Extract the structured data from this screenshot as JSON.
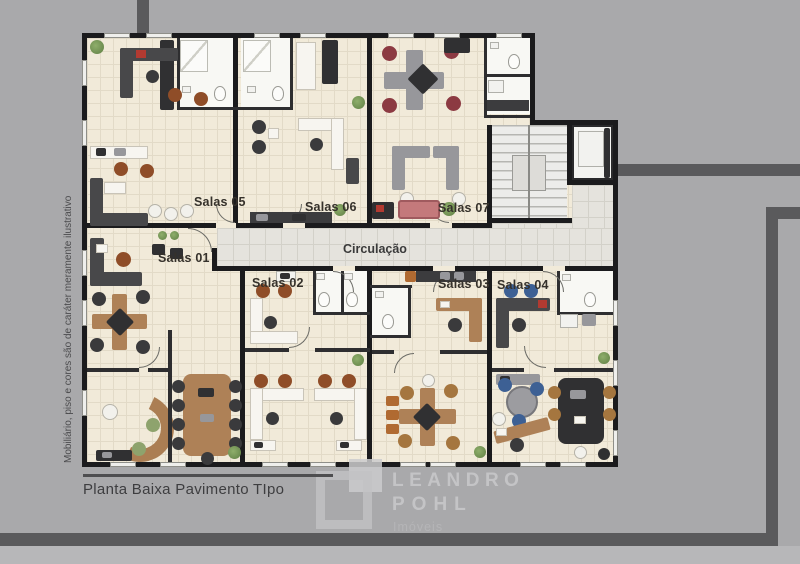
{
  "plan": {
    "rooms": [
      {
        "id": "salas-01",
        "label": "Salas 01"
      },
      {
        "id": "salas-02",
        "label": "Salas 02"
      },
      {
        "id": "salas-03",
        "label": "Salas 03"
      },
      {
        "id": "salas-04",
        "label": "Salas 04"
      },
      {
        "id": "salas-05",
        "label": "Salas 05"
      },
      {
        "id": "salas-06",
        "label": "Salas 06"
      },
      {
        "id": "salas-07",
        "label": "Salas 07"
      }
    ],
    "corridor": {
      "label": "Circulação"
    },
    "areas": [
      {
        "id": "staircase",
        "name": "staircase"
      },
      {
        "id": "elevator",
        "name": "elevator"
      }
    ]
  },
  "disclaimer": "Mobiliário, piso e cores são de caráter meramente ilustrativo",
  "caption": "Planta Baixa Pavimento TIpo",
  "logo": {
    "name": "LEANDRO",
    "surname": "POHL",
    "tagline": "Imóveis"
  },
  "colors": {
    "background": "#a9a9ab",
    "frame_line": "#5a5a5c",
    "wall": "#1b1b1d",
    "room_floor": "#f1ead9",
    "corridor_floor": "#e5e3dd",
    "sofa_red": "#c4797b",
    "wood": "#ae8157"
  }
}
